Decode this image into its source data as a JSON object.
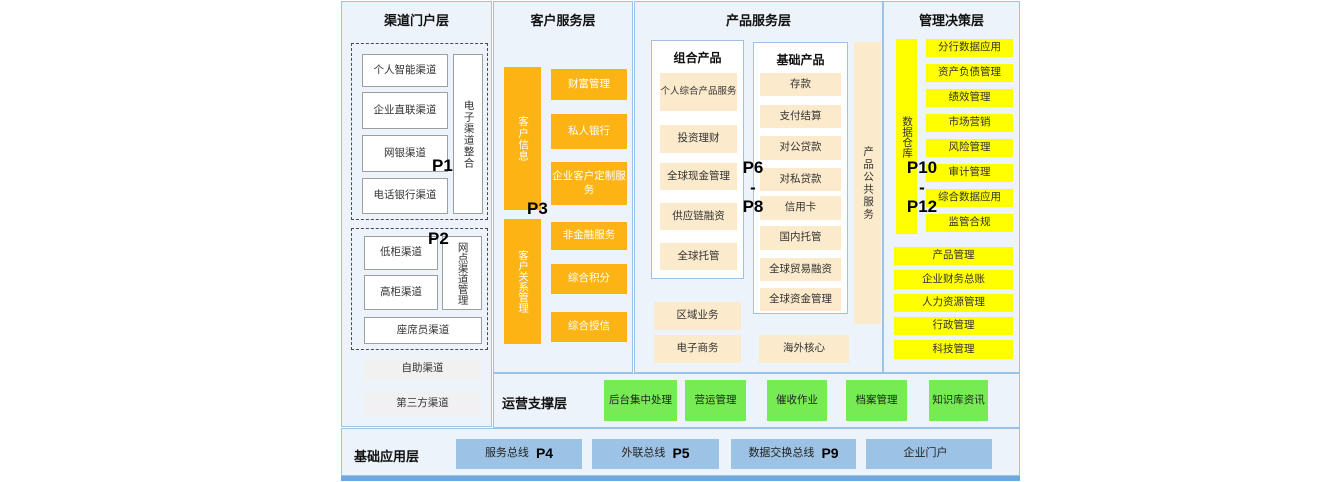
{
  "colors": {
    "panel_bg": "#EDF3FA",
    "panel_border": "#9CC3E6",
    "orange": "#FCB415",
    "cream": "#FBEACB",
    "yellow": "#FFFF00",
    "green": "#76EB54",
    "blue_box": "#9CC3E5",
    "bottom_strip": "#6FA8DC"
  },
  "layers": {
    "channel": {
      "title": "渠道门户层",
      "p1": "P1",
      "p2": "P2",
      "group1": {
        "vertical": "电子渠道整合",
        "items": [
          "个人智能渠道",
          "企业直联渠道",
          "网银渠道",
          "电话银行渠道"
        ]
      },
      "group2": {
        "vertical": "网点渠道管理",
        "items": [
          "低柜渠道",
          "高柜渠道"
        ],
        "wide": "座席员渠道"
      },
      "extra": [
        "自助渠道",
        "第三方渠道"
      ]
    },
    "customer": {
      "title": "客户服务层",
      "p3": "P3",
      "bar1": "客户信息",
      "bar2": "客户关系管理",
      "top_items": [
        "财富管理",
        "私人银行",
        "企业客户定制服务"
      ],
      "bottom_items": [
        "非金融服务",
        "综合积分",
        "综合授信"
      ]
    },
    "product": {
      "title": "产品服务层",
      "p_range": [
        "P6",
        "-",
        "P8"
      ],
      "combo": {
        "header": "组合产品",
        "items": [
          "个人综合产品服务",
          "投资理财",
          "全球现金管理",
          "供应链融资",
          "全球托管"
        ]
      },
      "basic": {
        "header": "基础产品",
        "items": [
          "存款",
          "支付结算",
          "对公贷款",
          "对私贷款",
          "信用卡",
          "国内托管",
          "全球贸易融资",
          "全球资金管理"
        ]
      },
      "vertical": "产品公共服务",
      "bottom_left": [
        "区域业务",
        "电子商务"
      ],
      "bottom_right": "海外核心"
    },
    "management": {
      "title": "管理决策层",
      "p_range": [
        "P10",
        "-",
        "P12"
      ],
      "vertical": "数据仓库",
      "items": [
        "分行数据应用",
        "资产负债管理",
        "绩效管理",
        "市场营销",
        "风险管理",
        "审计管理",
        "综合数据应用",
        "监管合规"
      ],
      "wide_items": [
        "产品管理",
        "企业财务总账",
        "人力资源管理",
        "行政管理",
        "科技管理"
      ]
    },
    "operations": {
      "title": "运营支撑层",
      "items": [
        "后台集中处理",
        "营运管理",
        "催收作业",
        "档案管理",
        "知识库资讯"
      ]
    },
    "foundation": {
      "title": "基础应用层",
      "items": [
        {
          "label": "服务总线",
          "p": "P4"
        },
        {
          "label": "外联总线",
          "p": "P5"
        },
        {
          "label": "数据交换总线",
          "p": "P9"
        },
        {
          "label": "企业门户",
          "p": ""
        }
      ]
    }
  }
}
